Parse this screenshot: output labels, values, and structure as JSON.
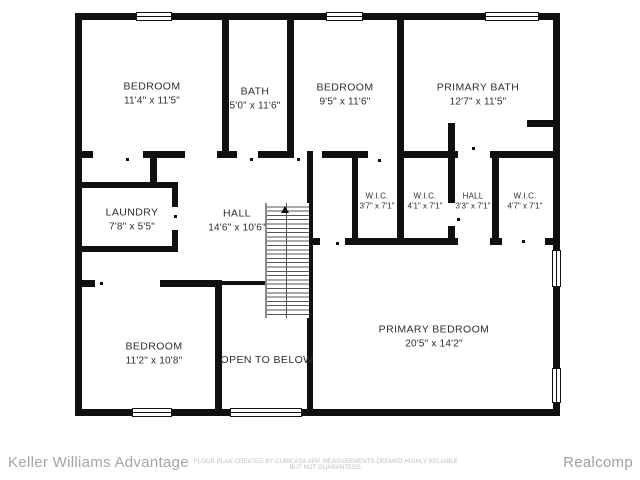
{
  "rooms": [
    {
      "name": "BEDROOM",
      "dims": "11'4\" x 11'5\""
    },
    {
      "name": "BATH",
      "dims": "5'0\" x 11'6\""
    },
    {
      "name": "BEDROOM",
      "dims": "9'5\" x 11'6\""
    },
    {
      "name": "PRIMARY BATH",
      "dims": "12'7\" x 11'5\""
    },
    {
      "name": "LAUNDRY",
      "dims": "7'8\" x 5'5\""
    },
    {
      "name": "HALL",
      "dims": "14'6\" x 10'6\""
    },
    {
      "name": "W.I.C.",
      "dims": "3'7\" x 7'1\""
    },
    {
      "name": "W.I.C.",
      "dims": "4'1\" x 7'1\""
    },
    {
      "name": "HALL",
      "dims": "3'3\" x 7'1\""
    },
    {
      "name": "W.I.C.",
      "dims": "4'7\" x 7'1\""
    },
    {
      "name": "BEDROOM",
      "dims": "11'2\" x 10'8\""
    },
    {
      "name": "OPEN TO BELOW",
      "dims": ""
    },
    {
      "name": "PRIMARY BEDROOM",
      "dims": "20'5\" x 14'2\""
    }
  ],
  "footer": {
    "agency": "Keller Williams Advantage",
    "disclaimer": "FLOOR PLAN CREATED BY CUBICASA APP. MEASUREMENTS DEEMED HIGHLY RELIABLE BUT NOT GUARANTEED.",
    "brand": "Realcomp"
  },
  "colors": {
    "wall": "#101010",
    "label_text": "#2e2e2e",
    "footer_text": "#a5a5a5"
  }
}
